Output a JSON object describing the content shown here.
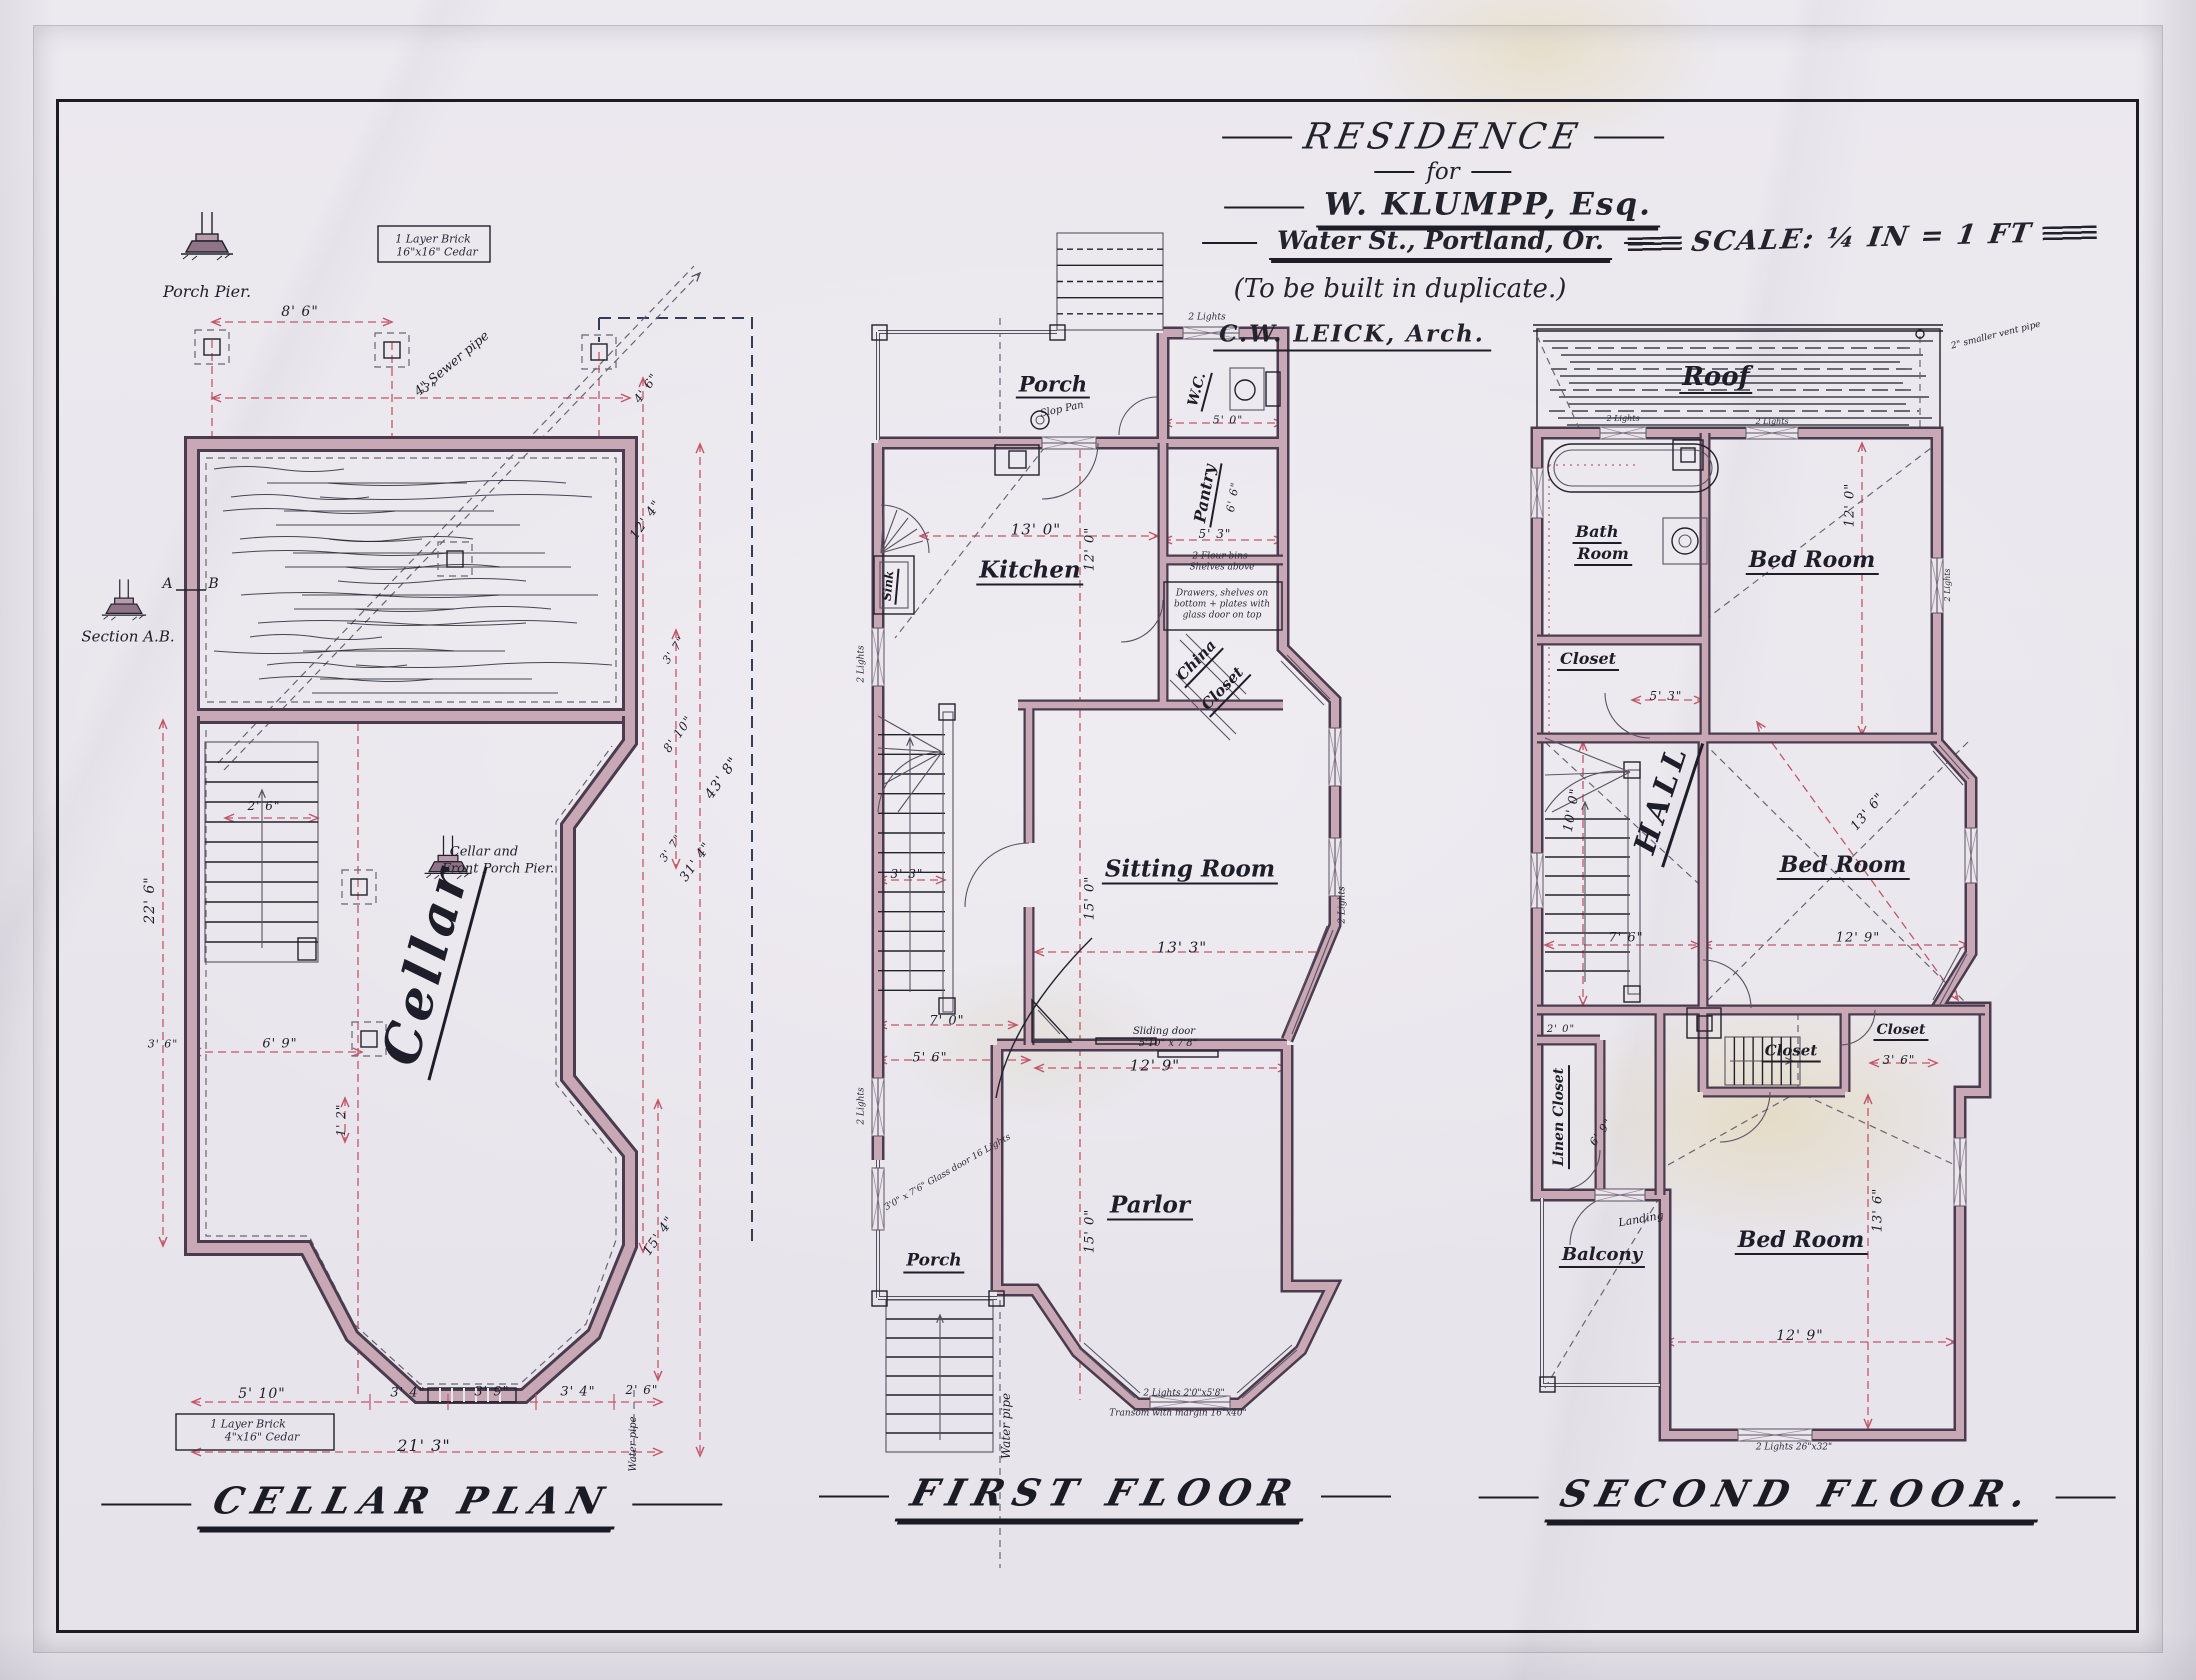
{
  "sheet": {
    "title": "RESIDENCE",
    "for_word": "for",
    "client": "W. KLUMPP, Esq.",
    "address": "Water St., Portland, Or.",
    "note": "(To be built in duplicate.)",
    "architect": "C.W. LEICK, Arch.",
    "scale": "SCALE: ¼ IN = 1 FT",
    "colors": {
      "paper": "#eae7ed",
      "ink": "#22222c",
      "wall": "#c9a8b6",
      "dimension_red": "#c25668"
    }
  },
  "plans": [
    {
      "id": "cellar",
      "title": "CELLAR PLAN",
      "labels": [
        {
          "t": "Porch Pier.",
          "x": 207,
          "y": 292,
          "s": 16,
          "c": "script",
          "n": "porch-pier-caption"
        },
        {
          "t": "8' 6\"",
          "x": 300,
          "y": 312,
          "s": 14,
          "c": "dim"
        },
        {
          "t": "3\"",
          "x": 430,
          "y": 388,
          "s": 12,
          "c": "dim"
        },
        {
          "t": "4\" Sewer pipe",
          "x": 452,
          "y": 364,
          "r": -40,
          "s": 13,
          "c": "script",
          "n": "sewer-pipe-note"
        },
        {
          "t": "1 Layer Brick",
          "x": 433,
          "y": 239,
          "s": 11,
          "c": "note"
        },
        {
          "t": "16\"x16\" Cedar",
          "x": 437,
          "y": 252,
          "s": 11,
          "c": "note"
        },
        {
          "t": "A",
          "x": 168,
          "y": 584,
          "s": 14,
          "c": "dim"
        },
        {
          "t": "B",
          "x": 214,
          "y": 584,
          "s": 14,
          "c": "dim"
        },
        {
          "t": "Section A.B.",
          "x": 128,
          "y": 637,
          "s": 15,
          "c": "script",
          "n": "section-ab-caption"
        },
        {
          "t": "2' 6\"",
          "x": 264,
          "y": 806,
          "s": 12,
          "c": "dim"
        },
        {
          "t": "Cellar and",
          "x": 484,
          "y": 852,
          "s": 13,
          "c": "script"
        },
        {
          "t": "Front Porch Pier.",
          "x": 498,
          "y": 869,
          "s": 13,
          "c": "script"
        },
        {
          "t": "Cellar",
          "x": 430,
          "y": 966,
          "r": -75,
          "s": 52,
          "c": "bigroom",
          "n": "cellar-room-label"
        },
        {
          "t": "22' 6\"",
          "x": 150,
          "y": 900,
          "r": -90,
          "s": 14,
          "c": "dim"
        },
        {
          "t": "3' 6\"",
          "x": 163,
          "y": 1044,
          "s": 11,
          "c": "dim"
        },
        {
          "t": "6' 9\"",
          "x": 280,
          "y": 1044,
          "s": 13,
          "c": "dim"
        },
        {
          "t": "1' 2\"",
          "x": 341,
          "y": 1120,
          "r": -90,
          "s": 12,
          "c": "dim"
        },
        {
          "t": "5' 10\"",
          "x": 262,
          "y": 1394,
          "s": 14,
          "c": "dim"
        },
        {
          "t": "3' 4\"",
          "x": 408,
          "y": 1393,
          "s": 13,
          "c": "dim"
        },
        {
          "t": "3' 9\"",
          "x": 492,
          "y": 1392,
          "s": 13,
          "c": "dim"
        },
        {
          "t": "3' 4\"",
          "x": 578,
          "y": 1392,
          "s": 13,
          "c": "dim"
        },
        {
          "t": "2' 6\"",
          "x": 642,
          "y": 1390,
          "s": 12,
          "c": "dim"
        },
        {
          "t": "21' 3\"",
          "x": 424,
          "y": 1446,
          "s": 16,
          "c": "dim"
        },
        {
          "t": "1 Layer Brick",
          "x": 248,
          "y": 1424,
          "s": 11,
          "c": "note"
        },
        {
          "t": "4\"x16\" Cedar",
          "x": 262,
          "y": 1437,
          "s": 11,
          "c": "note"
        },
        {
          "t": "4' 6\"",
          "x": 646,
          "y": 388,
          "r": -55,
          "s": 12,
          "c": "dim"
        },
        {
          "t": "12' 4\"",
          "x": 646,
          "y": 520,
          "r": -55,
          "s": 13,
          "c": "dim"
        },
        {
          "t": "3' 7\"",
          "x": 674,
          "y": 650,
          "r": -55,
          "s": 11,
          "c": "dim"
        },
        {
          "t": "8' 10\"",
          "x": 678,
          "y": 734,
          "r": -55,
          "s": 12,
          "c": "dim"
        },
        {
          "t": "3' 7\"",
          "x": 671,
          "y": 848,
          "r": -55,
          "s": 11,
          "c": "dim"
        },
        {
          "t": "43' 8\"",
          "x": 722,
          "y": 778,
          "r": -55,
          "s": 14,
          "c": "dim"
        },
        {
          "t": "31' 4\"",
          "x": 696,
          "y": 862,
          "r": -55,
          "s": 13,
          "c": "dim"
        },
        {
          "t": "15' 4\"",
          "x": 659,
          "y": 1236,
          "r": -55,
          "s": 13,
          "c": "dim"
        },
        {
          "t": "Water pipe",
          "x": 634,
          "y": 1444,
          "r": -90,
          "s": 10,
          "c": "script"
        },
        {
          "t": "Water pipe",
          "x": 1006,
          "y": 1426,
          "r": -90,
          "s": 12,
          "c": "script",
          "n": "water-pipe-note"
        }
      ]
    },
    {
      "id": "first",
      "title": "FIRST FLOOR",
      "labels": [
        {
          "t": "Porch",
          "x": 1053,
          "y": 386,
          "s": 21,
          "c": "room",
          "n": "porch-label"
        },
        {
          "t": "2 Lights",
          "x": 1207,
          "y": 318,
          "s": 9,
          "c": "note"
        },
        {
          "t": "Slop Pan",
          "x": 1062,
          "y": 410,
          "r": -12,
          "s": 10,
          "c": "script"
        },
        {
          "t": "W.C.",
          "x": 1199,
          "y": 390,
          "r": -75,
          "s": 14,
          "c": "room",
          "n": "wc-label"
        },
        {
          "t": "5' 0\"",
          "x": 1228,
          "y": 420,
          "s": 11,
          "c": "dim"
        },
        {
          "t": "Pantry",
          "x": 1207,
          "y": 494,
          "r": -80,
          "s": 16,
          "c": "room",
          "n": "pantry-label"
        },
        {
          "t": "6' 6\"",
          "x": 1233,
          "y": 497,
          "r": -80,
          "s": 11,
          "c": "dim"
        },
        {
          "t": "5' 3\"",
          "x": 1215,
          "y": 534,
          "s": 12,
          "c": "dim"
        },
        {
          "t": "2 Flour bins",
          "x": 1220,
          "y": 557,
          "s": 9,
          "c": "note"
        },
        {
          "t": "Shelves above",
          "x": 1222,
          "y": 568,
          "s": 9,
          "c": "note"
        },
        {
          "t": "Drawers, shelves on",
          "x": 1222,
          "y": 594,
          "s": 9,
          "c": "note"
        },
        {
          "t": "bottom + plates with",
          "x": 1222,
          "y": 605,
          "s": 9,
          "c": "note"
        },
        {
          "t": "glass door on top",
          "x": 1222,
          "y": 616,
          "s": 9,
          "c": "note"
        },
        {
          "t": "Kitchen",
          "x": 1030,
          "y": 572,
          "s": 23,
          "c": "room",
          "n": "kitchen-label"
        },
        {
          "t": "13' 0\"",
          "x": 1036,
          "y": 530,
          "s": 15,
          "c": "dim"
        },
        {
          "t": "12' 0\"",
          "x": 1090,
          "y": 549,
          "r": -90,
          "s": 13,
          "c": "dim"
        },
        {
          "t": "Sink",
          "x": 890,
          "y": 586,
          "r": -85,
          "s": 12,
          "c": "room"
        },
        {
          "t": "China",
          "x": 1198,
          "y": 662,
          "r": -46,
          "s": 15,
          "c": "room"
        },
        {
          "t": "Closet",
          "x": 1224,
          "y": 690,
          "r": -46,
          "s": 15,
          "c": "room"
        },
        {
          "t": "2 Lights",
          "x": 862,
          "y": 664,
          "r": -90,
          "s": 9,
          "c": "note"
        },
        {
          "t": "Sitting Room",
          "x": 1190,
          "y": 871,
          "s": 23,
          "c": "room",
          "n": "sitting-room-label"
        },
        {
          "t": "15' 0\"",
          "x": 1090,
          "y": 898,
          "r": -90,
          "s": 13,
          "c": "dim"
        },
        {
          "t": "13' 3\"",
          "x": 1182,
          "y": 948,
          "s": 15,
          "c": "dim"
        },
        {
          "t": "3' 3\"",
          "x": 907,
          "y": 874,
          "s": 12,
          "c": "dim"
        },
        {
          "t": "7' 0\"",
          "x": 947,
          "y": 1021,
          "s": 13,
          "c": "dim"
        },
        {
          "t": "5' 6\"",
          "x": 930,
          "y": 1058,
          "s": 13,
          "c": "dim"
        },
        {
          "t": "Sliding door",
          "x": 1164,
          "y": 1032,
          "s": 10,
          "c": "script"
        },
        {
          "t": "5'10\" x 7'8\"",
          "x": 1168,
          "y": 1044,
          "s": 10,
          "c": "script"
        },
        {
          "t": "12' 9\"",
          "x": 1155,
          "y": 1066,
          "s": 15,
          "c": "dim"
        },
        {
          "t": "2 Lights",
          "x": 1343,
          "y": 905,
          "r": -90,
          "s": 9,
          "c": "note"
        },
        {
          "t": "Parlor",
          "x": 1150,
          "y": 1207,
          "s": 23,
          "c": "room",
          "n": "parlor-label"
        },
        {
          "t": "15' 0\"",
          "x": 1090,
          "y": 1231,
          "r": -90,
          "s": 13,
          "c": "dim"
        },
        {
          "t": "Porch",
          "x": 934,
          "y": 1263,
          "s": 17,
          "c": "room"
        },
        {
          "t": "3'0\" x 7'6\" Glass door 16 Lights",
          "x": 948,
          "y": 1173,
          "r": -30,
          "s": 9,
          "c": "note"
        },
        {
          "t": "2 Lights",
          "x": 862,
          "y": 1106,
          "r": -90,
          "s": 9,
          "c": "note"
        },
        {
          "t": "2 Lights 2'0\"x5'8\"",
          "x": 1184,
          "y": 1394,
          "s": 9,
          "c": "note"
        },
        {
          "t": "Transom with margin 16\"x40\"",
          "x": 1178,
          "y": 1414,
          "s": 9,
          "c": "note"
        }
      ]
    },
    {
      "id": "second",
      "title": "SECOND FLOOR.",
      "labels": [
        {
          "t": "Roof",
          "x": 1716,
          "y": 379,
          "s": 26,
          "c": "room",
          "n": "roof-label"
        },
        {
          "t": "2\" smaller vent pipe",
          "x": 1996,
          "y": 336,
          "r": -14,
          "s": 9,
          "c": "script"
        },
        {
          "t": "2 Lights",
          "x": 1623,
          "y": 419,
          "s": 8,
          "c": "note"
        },
        {
          "t": "2 Lights",
          "x": 1772,
          "y": 422,
          "s": 8,
          "c": "note"
        },
        {
          "t": "Bath",
          "x": 1597,
          "y": 534,
          "s": 16,
          "c": "room",
          "n": "bath-room-label"
        },
        {
          "t": "Room",
          "x": 1603,
          "y": 556,
          "s": 16,
          "c": "room"
        },
        {
          "t": "Bed Room",
          "x": 1812,
          "y": 562,
          "s": 22,
          "c": "room",
          "n": "bedroom-1-label"
        },
        {
          "t": "12' 0\"",
          "x": 1850,
          "y": 505,
          "r": -90,
          "s": 13,
          "c": "dim"
        },
        {
          "t": "2 Lights",
          "x": 1948,
          "y": 585,
          "r": -90,
          "s": 8,
          "c": "note"
        },
        {
          "t": "Closet",
          "x": 1588,
          "y": 661,
          "s": 16,
          "c": "room"
        },
        {
          "t": "5' 3\"",
          "x": 1666,
          "y": 696,
          "s": 12,
          "c": "dim"
        },
        {
          "t": "HALL",
          "x": 1666,
          "y": 800,
          "r": -72,
          "s": 30,
          "c": "bigroom",
          "n": "hall-label"
        },
        {
          "t": "10' 0\"",
          "x": 1572,
          "y": 810,
          "r": -80,
          "s": 13,
          "c": "dim"
        },
        {
          "t": "7' 6\"",
          "x": 1626,
          "y": 938,
          "s": 13,
          "c": "dim"
        },
        {
          "t": "Bed Room",
          "x": 1843,
          "y": 867,
          "s": 22,
          "c": "room",
          "n": "bedroom-2-label"
        },
        {
          "t": "13' 6\"",
          "x": 1868,
          "y": 812,
          "r": -50,
          "s": 13,
          "c": "dim"
        },
        {
          "t": "12' 9\"",
          "x": 1858,
          "y": 938,
          "s": 13,
          "c": "dim"
        },
        {
          "t": "Closet",
          "x": 1791,
          "y": 1053,
          "s": 15,
          "c": "room"
        },
        {
          "t": "Closet",
          "x": 1901,
          "y": 1032,
          "s": 14,
          "c": "room"
        },
        {
          "t": "3' 6\"",
          "x": 1899,
          "y": 1060,
          "s": 12,
          "c": "dim"
        },
        {
          "t": "Linen Closet",
          "x": 1561,
          "y": 1117,
          "r": -90,
          "s": 14,
          "c": "room",
          "n": "linen-closet-label"
        },
        {
          "t": "2' 0\"",
          "x": 1561,
          "y": 1030,
          "s": 10,
          "c": "dim"
        },
        {
          "t": "6' 9\"",
          "x": 1601,
          "y": 1132,
          "r": -55,
          "s": 11,
          "c": "dim"
        },
        {
          "t": "Landing",
          "x": 1641,
          "y": 1219,
          "r": -10,
          "s": 11,
          "c": "script"
        },
        {
          "t": "Balcony",
          "x": 1602,
          "y": 1257,
          "s": 18,
          "c": "room",
          "n": "balcony-label"
        },
        {
          "t": "Bed Room",
          "x": 1801,
          "y": 1242,
          "s": 22,
          "c": "room",
          "n": "bedroom-3-label"
        },
        {
          "t": "13' 6\"",
          "x": 1878,
          "y": 1210,
          "r": -90,
          "s": 13,
          "c": "dim"
        },
        {
          "t": "12' 9\"",
          "x": 1800,
          "y": 1336,
          "s": 14,
          "c": "dim"
        },
        {
          "t": "2 Lights 26\"x32\"",
          "x": 1794,
          "y": 1448,
          "s": 9,
          "c": "note"
        }
      ]
    }
  ]
}
